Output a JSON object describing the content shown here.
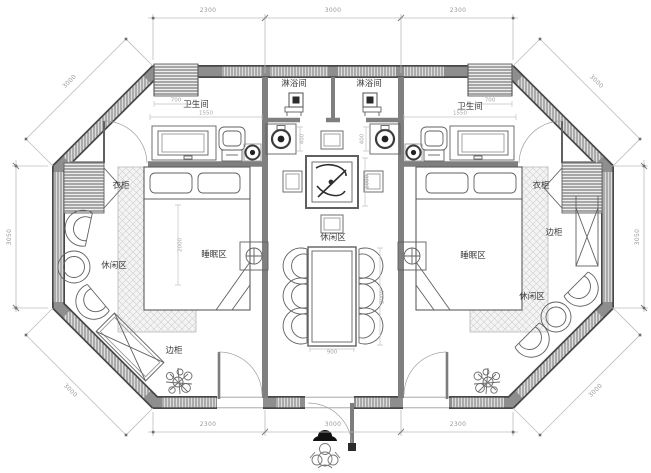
{
  "drawing": {
    "type": "floor-plan",
    "shape": "octagon",
    "description": "symmetric twin-suite plan with central lounge corridor"
  },
  "rooms": {
    "shower_left": "淋浴间",
    "shower_right": "淋浴间",
    "bath_left": "卫生间",
    "bath_right": "卫生间",
    "wardrobe_left": "衣柜",
    "wardrobe_right": "衣柜",
    "sleep_left": "睡眠区",
    "sleep_right": "睡眠区",
    "lounge_left": "休闲区",
    "lounge_center": "休闲区",
    "lounge_right": "休闲区",
    "cabinet_left": "边柜",
    "cabinet_right": "边柜"
  },
  "dims": {
    "top": [
      "2300",
      "3000",
      "2300"
    ],
    "bottom": [
      "2300",
      "3000",
      "2300"
    ],
    "left_side": "3050",
    "right_side": "3050",
    "diag_top_left": "3000",
    "diag_top_right": "3000",
    "diag_bottom_left": "3000",
    "diag_bottom_right": "3000",
    "minor": [
      "700",
      "700",
      "1550",
      "1550",
      "400",
      "400",
      "1000",
      "900",
      "2000",
      "2000"
    ]
  },
  "colors": {
    "wall_fill": "#8e8e8e",
    "wall_edge": "#474747",
    "furniture_line": "#606060",
    "dimension_line": "#bdbdbd",
    "dimension_text": "#999999",
    "label_text": "#3d3d3d",
    "window_fill": "#dcdcdc",
    "background": "#ffffff"
  }
}
